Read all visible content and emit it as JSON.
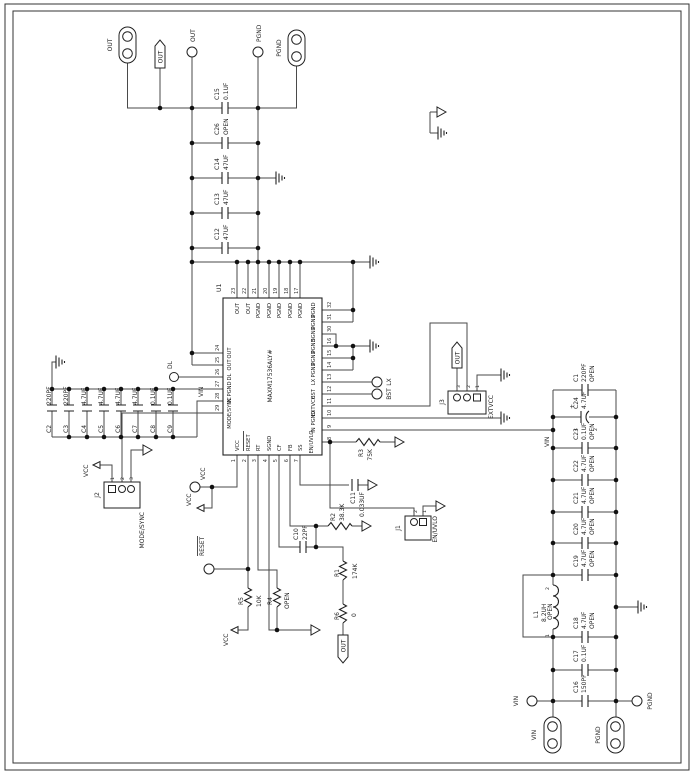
{
  "u1": {
    "ref": "U1",
    "part": "MAXM17536ALY#"
  },
  "nets": {
    "out": "OUT",
    "pgnd": "PGND",
    "vin": "VIN",
    "vcc": "VCC",
    "reset": "RESET",
    "lx": "LX",
    "bst": "BST",
    "dl": "DL",
    "plus": "+"
  },
  "pins": {
    "top": [
      {
        "n": "23",
        "name": "OUT"
      },
      {
        "n": "22",
        "name": "OUT"
      },
      {
        "n": "21",
        "name": "PGND"
      },
      {
        "n": "20",
        "name": "PGND"
      },
      {
        "n": "19",
        "name": "PGND"
      },
      {
        "n": "18",
        "name": "PGND"
      },
      {
        "n": "17",
        "name": "PGND"
      }
    ],
    "right": [
      {
        "n": "32",
        "name": "PGND"
      },
      {
        "n": "31",
        "name": "PGND"
      },
      {
        "n": "30",
        "name": "SGND"
      },
      {
        "n": "16",
        "name": "PGND"
      },
      {
        "n": "15",
        "name": "PGND"
      },
      {
        "n": "14",
        "name": "PGND"
      },
      {
        "n": "13",
        "name": "LX"
      },
      {
        "n": "12",
        "name": "BST"
      },
      {
        "n": "11",
        "name": "EXTVCC"
      },
      {
        "n": "10",
        "name": "PGND"
      },
      {
        "n": "9",
        "name": "IN"
      },
      {
        "n": "8",
        "name": "EN/UVLO"
      }
    ],
    "left": [
      {
        "n": "24",
        "name": "OUT"
      },
      {
        "n": "25",
        "name": "OUT"
      },
      {
        "n": "26",
        "name": "DL"
      },
      {
        "n": "27",
        "name": "PGND"
      },
      {
        "n": "28",
        "name": "IN"
      },
      {
        "n": "29",
        "name": "MODE/SYNC"
      }
    ],
    "bottom": [
      {
        "n": "1",
        "name": "VCC"
      },
      {
        "n": "2",
        "name": "RESET"
      },
      {
        "n": "3",
        "name": "RT"
      },
      {
        "n": "4",
        "name": "SGND"
      },
      {
        "n": "5",
        "name": "CF"
      },
      {
        "n": "6",
        "name": "FB"
      },
      {
        "n": "7",
        "name": "SS"
      }
    ]
  },
  "caps_out": [
    {
      "name": "C15",
      "value": "0.1UF"
    },
    {
      "name": "C26",
      "value": "OPEN"
    },
    {
      "name": "C14",
      "value": "47UF"
    },
    {
      "name": "C13",
      "value": "47UF"
    },
    {
      "name": "C12",
      "value": "47UF"
    }
  ],
  "caps_in_left": [
    {
      "name": "C2",
      "value": "220PF"
    },
    {
      "name": "C3",
      "value": "220PF"
    },
    {
      "name": "C4",
      "value": "4.7UF"
    },
    {
      "name": "C5",
      "value": "4.7UF"
    },
    {
      "name": "C6",
      "value": "4.7UF"
    },
    {
      "name": "C7",
      "value": "4.7UF"
    },
    {
      "name": "C8",
      "value": "0.1UF"
    },
    {
      "name": "C9",
      "value": "0.1UF"
    }
  ],
  "bank": {
    "c1": {
      "name": "C1",
      "value": "220PF",
      "note": "OPEN"
    },
    "c24": {
      "name": "C24",
      "value": "4.7UF",
      "plus": "+",
      "p1": "1",
      "p2": "2"
    },
    "c23": {
      "name": "C23",
      "value": "0.1UF",
      "note": "OPEN"
    },
    "c22": {
      "name": "C22",
      "value": "4.7UF",
      "note": "OPEN"
    },
    "c21": {
      "name": "C21",
      "value": "4.7UF",
      "note": "OPEN"
    },
    "c20": {
      "name": "C20",
      "value": "4.7UF",
      "note": "OPEN"
    },
    "c19": {
      "name": "C19",
      "value": "4.7UF",
      "note": "OPEN"
    },
    "l1": {
      "name": "L1",
      "value": "8.2UH",
      "note": "OPEN",
      "p1": "1",
      "p2": "2"
    },
    "c18": {
      "name": "C18",
      "value": "4.7UF",
      "note": "OPEN"
    },
    "c17": {
      "name": "C17",
      "value": "0.1UF"
    },
    "c16": {
      "name": "C16",
      "value": "150PF"
    }
  },
  "r": {
    "r1": {
      "name": "R1",
      "value": "174K"
    },
    "r2": {
      "name": "R2",
      "value": "38.3K"
    },
    "r3": {
      "name": "R3",
      "value": "75K"
    },
    "r4": {
      "name": "R4",
      "value": "OPEN"
    },
    "r5": {
      "name": "R5",
      "value": "10K"
    },
    "r6": {
      "name": "R6",
      "value": "0"
    }
  },
  "c": {
    "c10": {
      "name": "C10",
      "value": "22PF"
    },
    "c11": {
      "name": "C11",
      "value": "0.033UF"
    }
  },
  "j": {
    "j1": {
      "ref": "J1",
      "label": "EN/UVLO",
      "p": [
        "2",
        "1"
      ]
    },
    "j2": {
      "ref": "J2",
      "label": "MODE/SYNC",
      "p": [
        "1",
        "2",
        "3"
      ]
    },
    "j3": {
      "ref": "J3",
      "label": "EXTVCC",
      "p": [
        "3",
        "2",
        "1"
      ]
    }
  }
}
